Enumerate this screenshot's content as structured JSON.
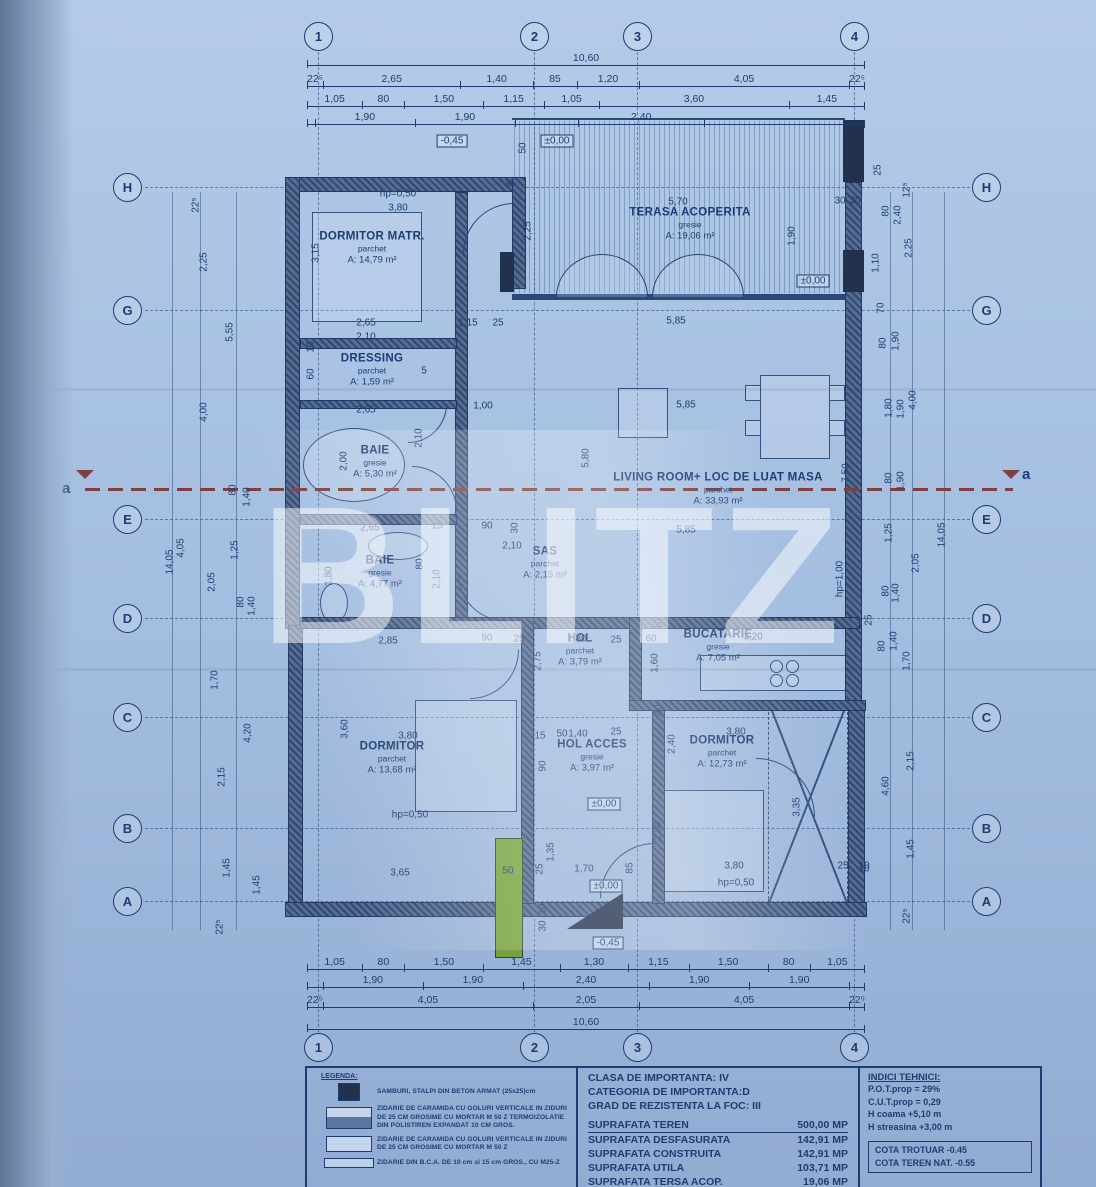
{
  "watermark": "BLITZ",
  "colors": {
    "paper": "#a7c1e2",
    "ink": "#1d3d72",
    "wall": "#47608c",
    "column": "#22314d",
    "section": "#7c4040",
    "green": "#76a13e"
  },
  "grid": {
    "cols": [
      "1",
      "2",
      "3",
      "4"
    ],
    "rows": [
      "H",
      "G",
      "E",
      "D",
      "C",
      "B",
      "A"
    ]
  },
  "section": {
    "label": "a"
  },
  "rooms": [
    {
      "name": "DORMITOR MATR.",
      "floor": "parchet",
      "area": "A: 14,79 m²",
      "cx": 372,
      "cy": 248
    },
    {
      "name": "TERASA ACOPERITA",
      "floor": "gresie",
      "area": "A: 19,06 m²",
      "cx": 690,
      "cy": 224
    },
    {
      "name": "DRESSING",
      "floor": "parchet",
      "area": "A: 1,59 m²",
      "cx": 372,
      "cy": 370
    },
    {
      "name": "BAIE",
      "floor": "gresie",
      "area": "A: 5,30 m²",
      "cx": 375,
      "cy": 462
    },
    {
      "name": "BAIE",
      "floor": "gresie",
      "area": "A: 4,77 m²",
      "cx": 380,
      "cy": 572
    },
    {
      "name": "SAS",
      "floor": "parchet",
      "area": "A: 2,15 m²",
      "cx": 545,
      "cy": 563
    },
    {
      "name": "LIVING ROOM+ LOC DE LUAT MASA",
      "floor": "parchet",
      "area": "A: 33,93 m²",
      "cx": 718,
      "cy": 489
    },
    {
      "name": "HOL",
      "floor": "parchet",
      "area": "A: 3,79 m²",
      "cx": 580,
      "cy": 650
    },
    {
      "name": "BUCATARIE",
      "floor": "gresie",
      "area": "A: 7,05 m²",
      "cx": 718,
      "cy": 646
    },
    {
      "name": "DORMITOR",
      "floor": "parchet",
      "area": "A: 13,68 m²",
      "cx": 392,
      "cy": 758
    },
    {
      "name": "HOL ACCES",
      "floor": "gresie",
      "area": "A: 3,97 m²",
      "cx": 592,
      "cy": 756
    },
    {
      "name": "DORMITOR",
      "floor": "parchet",
      "area": "A: 12,73 m²",
      "cx": 722,
      "cy": 752
    }
  ],
  "chains": [
    {
      "x": 307,
      "y": 52,
      "w": 558,
      "segs": [
        {
          "t": "10,60",
          "w": 10.6
        }
      ]
    },
    {
      "x": 307,
      "y": 73,
      "w": 558,
      "segs": [
        {
          "t": "22⁵",
          "w": 0.225
        },
        {
          "t": "2,65",
          "w": 2.65
        },
        {
          "t": "1,40",
          "w": 1.4
        },
        {
          "t": "85",
          "w": 0.85
        },
        {
          "t": "1,20",
          "w": 1.2
        },
        {
          "t": "4,05",
          "w": 4.05
        },
        {
          "t": "22⁵",
          "w": 0.225
        }
      ]
    },
    {
      "x": 307,
      "y": 93,
      "w": 558,
      "segs": [
        {
          "t": "1,05",
          "w": 1.05
        },
        {
          "t": "80",
          "w": 0.8
        },
        {
          "t": "1,50",
          "w": 1.5
        },
        {
          "t": "1,15",
          "w": 1.15
        },
        {
          "t": "1,05",
          "w": 1.05
        },
        {
          "t": "3,60",
          "w": 3.6
        },
        {
          "t": "1,45",
          "w": 1.45
        }
      ]
    },
    {
      "x": 307,
      "y": 111,
      "w": 558,
      "segs": [
        {
          "t": "",
          "w": 0.15
        },
        {
          "t": "1,90",
          "w": 1.9
        },
        {
          "t": "1,90",
          "w": 1.9
        },
        {
          "t": "",
          "w": 1.2
        },
        {
          "t": "2,40",
          "w": 2.4
        },
        {
          "t": "",
          "w": 3.05
        }
      ]
    },
    {
      "x": 307,
      "y": 956,
      "w": 558,
      "segs": [
        {
          "t": "1,05",
          "w": 1.05
        },
        {
          "t": "80",
          "w": 0.8
        },
        {
          "t": "1,50",
          "w": 1.5
        },
        {
          "t": "1,45",
          "w": 1.45
        },
        {
          "t": "1,30",
          "w": 1.3
        },
        {
          "t": "1,15",
          "w": 1.15
        },
        {
          "t": "1,50",
          "w": 1.5
        },
        {
          "t": "80",
          "w": 0.8
        },
        {
          "t": "1,05",
          "w": 1.05
        }
      ]
    },
    {
      "x": 307,
      "y": 974,
      "w": 558,
      "segs": [
        {
          "t": "",
          "w": 0.3
        },
        {
          "t": "1,90",
          "w": 1.9
        },
        {
          "t": "1,90",
          "w": 1.9
        },
        {
          "t": "2,40",
          "w": 2.4
        },
        {
          "t": "1,90",
          "w": 1.9
        },
        {
          "t": "1,90",
          "w": 1.9
        },
        {
          "t": "",
          "w": 0.3
        }
      ]
    },
    {
      "x": 307,
      "y": 994,
      "w": 558,
      "segs": [
        {
          "t": "22⁵",
          "w": 0.225
        },
        {
          "t": "4,05",
          "w": 4.05
        },
        {
          "t": "2,05",
          "w": 2.05
        },
        {
          "t": "4,05",
          "w": 4.05
        },
        {
          "t": "22⁵",
          "w": 0.225
        }
      ]
    },
    {
      "x": 307,
      "y": 1016,
      "w": 558,
      "segs": [
        {
          "t": "10,60",
          "w": 10.6
        }
      ]
    }
  ],
  "labels": [
    {
      "t": "-0,45",
      "x": 452,
      "y": 141,
      "b": 1
    },
    {
      "t": "50",
      "x": 523,
      "y": 148,
      "v": 1
    },
    {
      "t": "±0,00",
      "x": 557,
      "y": 141,
      "b": 1
    },
    {
      "t": "35",
      "x": 510,
      "y": 184
    },
    {
      "t": "hp=0,50",
      "x": 398,
      "y": 194
    },
    {
      "t": "3,80",
      "x": 398,
      "y": 208
    },
    {
      "t": "3,15",
      "x": 316,
      "y": 253,
      "v": 1
    },
    {
      "t": "5,70",
      "x": 678,
      "y": 202
    },
    {
      "t": "1,90",
      "x": 792,
      "y": 236,
      "v": 1
    },
    {
      "t": "±0,00",
      "x": 813,
      "y": 281,
      "b": 1
    },
    {
      "t": "30",
      "x": 840,
      "y": 201
    },
    {
      "t": "30",
      "x": 855,
      "y": 201
    },
    {
      "t": "2,25",
      "x": 528,
      "y": 231,
      "v": 1
    },
    {
      "t": "2,65",
      "x": 366,
      "y": 323
    },
    {
      "t": "2,10",
      "x": 366,
      "y": 337
    },
    {
      "t": "1,15",
      "x": 468,
      "y": 323
    },
    {
      "t": "25",
      "x": 498,
      "y": 323
    },
    {
      "t": "5,85",
      "x": 676,
      "y": 321
    },
    {
      "t": "10",
      "x": 311,
      "y": 347,
      "v": 1
    },
    {
      "t": "60",
      "x": 311,
      "y": 374,
      "v": 1
    },
    {
      "t": "5",
      "x": 424,
      "y": 371
    },
    {
      "t": "1,00",
      "x": 483,
      "y": 406
    },
    {
      "t": "2,65",
      "x": 366,
      "y": 410
    },
    {
      "t": "5,85",
      "x": 686,
      "y": 405
    },
    {
      "t": "2,00",
      "x": 344,
      "y": 461,
      "v": 1
    },
    {
      "t": "2,10",
      "x": 419,
      "y": 438,
      "v": 1
    },
    {
      "t": "5,80",
      "x": 586,
      "y": 458,
      "v": 1
    },
    {
      "t": "7,50",
      "x": 846,
      "y": 473,
      "v": 1
    },
    {
      "t": "2,65",
      "x": 370,
      "y": 528
    },
    {
      "t": "15",
      "x": 437,
      "y": 526
    },
    {
      "t": "90",
      "x": 487,
      "y": 526
    },
    {
      "t": "30",
      "x": 515,
      "y": 528,
      "v": 1
    },
    {
      "t": "2,10",
      "x": 512,
      "y": 546
    },
    {
      "t": "1,80",
      "x": 329,
      "y": 576,
      "v": 1
    },
    {
      "t": "80",
      "x": 420,
      "y": 564,
      "v": 1
    },
    {
      "t": "2,10",
      "x": 437,
      "y": 579,
      "v": 1
    },
    {
      "t": "5,85",
      "x": 686,
      "y": 530
    },
    {
      "t": "hp=1,00",
      "x": 840,
      "y": 579,
      "v": 1
    },
    {
      "t": "2,85",
      "x": 388,
      "y": 641
    },
    {
      "t": "90",
      "x": 487,
      "y": 638
    },
    {
      "t": "25",
      "x": 519,
      "y": 639
    },
    {
      "t": "2,75",
      "x": 538,
      "y": 661,
      "v": 1
    },
    {
      "t": "1,80",
      "x": 577,
      "y": 639
    },
    {
      "t": "25",
      "x": 616,
      "y": 640
    },
    {
      "t": "60",
      "x": 651,
      "y": 639
    },
    {
      "t": "1,60",
      "x": 655,
      "y": 663,
      "v": 1
    },
    {
      "t": "3,20",
      "x": 753,
      "y": 637
    },
    {
      "t": "40",
      "x": 659,
      "y": 710,
      "v": 1
    },
    {
      "t": "10",
      "x": 659,
      "y": 624,
      "v": 1
    },
    {
      "t": "3,60",
      "x": 345,
      "y": 729,
      "v": 1
    },
    {
      "t": "3,80",
      "x": 408,
      "y": 736
    },
    {
      "t": "15",
      "x": 540,
      "y": 736
    },
    {
      "t": "50",
      "x": 562,
      "y": 734
    },
    {
      "t": "1,40",
      "x": 578,
      "y": 734
    },
    {
      "t": "25",
      "x": 616,
      "y": 732
    },
    {
      "t": "90",
      "x": 543,
      "y": 766,
      "v": 1
    },
    {
      "t": "±0,00",
      "x": 604,
      "y": 804,
      "b": 1
    },
    {
      "t": "2,30",
      "x": 658,
      "y": 831,
      "v": 1
    },
    {
      "t": "2,40",
      "x": 672,
      "y": 744,
      "v": 1
    },
    {
      "t": "3,80",
      "x": 736,
      "y": 732
    },
    {
      "t": "3,35",
      "x": 797,
      "y": 807,
      "v": 1
    },
    {
      "t": "25",
      "x": 843,
      "y": 866
    },
    {
      "t": "10",
      "x": 864,
      "y": 866
    },
    {
      "t": "hp=0,50",
      "x": 410,
      "y": 815
    },
    {
      "t": "3,65",
      "x": 400,
      "y": 873
    },
    {
      "t": "50",
      "x": 508,
      "y": 871
    },
    {
      "t": "25",
      "x": 540,
      "y": 869,
      "v": 1
    },
    {
      "t": "1,35",
      "x": 551,
      "y": 852,
      "v": 1
    },
    {
      "t": "1,70",
      "x": 584,
      "y": 869
    },
    {
      "t": "±0,00",
      "x": 606,
      "y": 886,
      "b": 1
    },
    {
      "t": "85",
      "x": 630,
      "y": 868,
      "v": 1
    },
    {
      "t": "30",
      "x": 543,
      "y": 909,
      "v": 1
    },
    {
      "t": "30",
      "x": 543,
      "y": 926,
      "v": 1
    },
    {
      "t": "-0,45",
      "x": 608,
      "y": 943,
      "b": 1
    },
    {
      "t": "3,80",
      "x": 734,
      "y": 866
    },
    {
      "t": "hp=0,50",
      "x": 736,
      "y": 883
    },
    {
      "t": "22⁵",
      "x": 196,
      "y": 205,
      "v": 1
    },
    {
      "t": "2,25",
      "x": 204,
      "y": 262,
      "v": 1
    },
    {
      "t": "5,55",
      "x": 230,
      "y": 332,
      "v": 1
    },
    {
      "t": "4,00",
      "x": 204,
      "y": 412,
      "v": 1
    },
    {
      "t": "80",
      "x": 233,
      "y": 490,
      "v": 1
    },
    {
      "t": "1,40",
      "x": 247,
      "y": 497,
      "v": 1
    },
    {
      "t": "14,05",
      "x": 170,
      "y": 562,
      "v": 1
    },
    {
      "t": "4,05",
      "x": 181,
      "y": 548,
      "v": 1
    },
    {
      "t": "1,25",
      "x": 235,
      "y": 550,
      "v": 1
    },
    {
      "t": "2,05",
      "x": 212,
      "y": 582,
      "v": 1
    },
    {
      "t": "80",
      "x": 241,
      "y": 602,
      "v": 1
    },
    {
      "t": "1,40",
      "x": 252,
      "y": 606,
      "v": 1
    },
    {
      "t": "1,70",
      "x": 215,
      "y": 680,
      "v": 1
    },
    {
      "t": "4,20",
      "x": 248,
      "y": 733,
      "v": 1
    },
    {
      "t": "2,15",
      "x": 222,
      "y": 777,
      "v": 1
    },
    {
      "t": "1,45",
      "x": 227,
      "y": 868,
      "v": 1
    },
    {
      "t": "1,45",
      "x": 257,
      "y": 885,
      "v": 1
    },
    {
      "t": "22⁵",
      "x": 220,
      "y": 927,
      "v": 1
    },
    {
      "t": "25",
      "x": 878,
      "y": 170,
      "v": 1
    },
    {
      "t": "12⁵",
      "x": 907,
      "y": 190,
      "v": 1
    },
    {
      "t": "80",
      "x": 886,
      "y": 211,
      "v": 1
    },
    {
      "t": "2,40",
      "x": 898,
      "y": 215,
      "v": 1
    },
    {
      "t": "2,25",
      "x": 909,
      "y": 248,
      "v": 1
    },
    {
      "t": "1,10",
      "x": 876,
      "y": 263,
      "v": 1
    },
    {
      "t": "70",
      "x": 881,
      "y": 308,
      "v": 1
    },
    {
      "t": "80",
      "x": 883,
      "y": 343,
      "v": 1
    },
    {
      "t": "1,90",
      "x": 896,
      "y": 341,
      "v": 1
    },
    {
      "t": "4,00",
      "x": 913,
      "y": 400,
      "v": 1
    },
    {
      "t": "1,80",
      "x": 889,
      "y": 408,
      "v": 1
    },
    {
      "t": "1,90",
      "x": 901,
      "y": 409,
      "v": 1
    },
    {
      "t": "80",
      "x": 889,
      "y": 478,
      "v": 1
    },
    {
      "t": "1,90",
      "x": 901,
      "y": 481,
      "v": 1
    },
    {
      "t": "1,25",
      "x": 889,
      "y": 533,
      "v": 1
    },
    {
      "t": "14,05",
      "x": 942,
      "y": 535,
      "v": 1
    },
    {
      "t": "2,05",
      "x": 916,
      "y": 563,
      "v": 1
    },
    {
      "t": "80",
      "x": 886,
      "y": 591,
      "v": 1
    },
    {
      "t": "1,40",
      "x": 896,
      "y": 593,
      "v": 1
    },
    {
      "t": "25",
      "x": 869,
      "y": 620,
      "v": 1
    },
    {
      "t": "1,40",
      "x": 894,
      "y": 641,
      "v": 1
    },
    {
      "t": "80",
      "x": 882,
      "y": 646,
      "v": 1
    },
    {
      "t": "1,70",
      "x": 907,
      "y": 661,
      "v": 1
    },
    {
      "t": "2,15",
      "x": 911,
      "y": 761,
      "v": 1
    },
    {
      "t": "4,60",
      "x": 886,
      "y": 786,
      "v": 1
    },
    {
      "t": "1,45",
      "x": 911,
      "y": 849,
      "v": 1
    },
    {
      "t": "10",
      "x": 864,
      "y": 869
    },
    {
      "t": "22⁵",
      "x": 907,
      "y": 916,
      "v": 1
    }
  ],
  "panel": {
    "legend": {
      "title": "LEGENDA:",
      "items": [
        {
          "swatch": "column",
          "text": "SAMBURI, STALPI DIN BETON ARMAT (25x25)cm"
        },
        {
          "swatch": "wall-thermo",
          "text": "ZIDARIE DE CARAMIDA CU GOLURI VERTICALE IN ZIDURI DE 25 CM GROSIME CU MORTAR M 50 Z TERMOIZOLATIE DIN POLISTIREN EXPANDAT 10 CM GROS."
        },
        {
          "swatch": "wall",
          "text": "ZIDARIE DE CARAMIDA CU GOLURI VERTICALE IN ZIDURI DE 25 CM GROSIME CU MORTAR M 50 Z"
        },
        {
          "swatch": "bca",
          "text": "ZIDARIE DIN B.C.A. DE 10 cm si 15 cm GROS., CU M25-Z"
        }
      ]
    },
    "center": {
      "clasa": "CLASA DE IMPORTANTA: IV",
      "categoria": "CATEGORIA DE IMPORTANTA:D",
      "grad": "GRAD DE REZISTENTA LA FOC: III",
      "suprafete": [
        {
          "k": "SUPRAFATA TEREN",
          "v": "500,00 MP"
        },
        {
          "k": "SUPRAFATA DESFASURATA",
          "v": "142,91 MP"
        },
        {
          "k": "SUPRAFATA CONSTRUITA",
          "v": "142,91 MP"
        },
        {
          "k": "SUPRAFATA UTILA",
          "v": "103,71 MP"
        },
        {
          "k": "SUPRAFATA TERSA ACOP.",
          "v": "19,06 MP"
        }
      ]
    },
    "right": {
      "title": "INDICI TEHNICI:",
      "items": [
        "P.O.T.prop = 29%",
        "C.U.T.prop = 0,29",
        "H coama  +5,10 m",
        "H streasina  +3,00 m"
      ],
      "cota": [
        "COTA TROTUAR -0.45",
        "COTA TEREN NAT. -0.55"
      ]
    }
  }
}
